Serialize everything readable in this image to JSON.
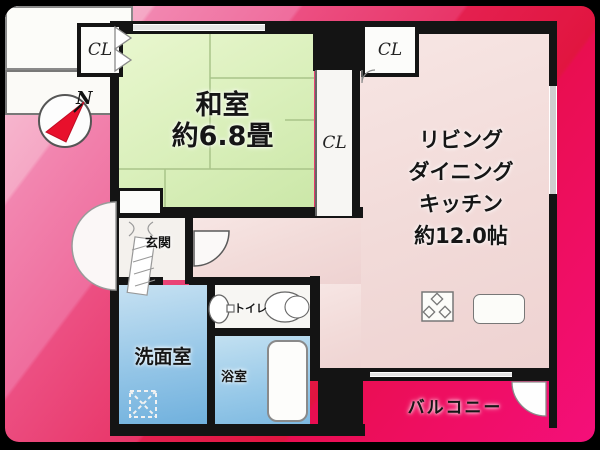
{
  "compass": {
    "label": "N"
  },
  "plan": {
    "closet_topleft": {
      "label": "CL"
    },
    "closet_topright": {
      "label": "CL"
    },
    "closet_tall": {
      "label": "CL"
    },
    "washitsu": {
      "name": "和室",
      "size": "約6.8畳"
    },
    "ldk": {
      "lines": [
        "リビング",
        "ダイニング",
        "キッチン",
        "約12.0帖"
      ]
    },
    "genkan": {
      "name": "玄関"
    },
    "toilet": {
      "name": "トイレ"
    },
    "washroom": {
      "name": "洗面室"
    },
    "bathroom": {
      "name": "浴室"
    },
    "balcony": {
      "name": "バルコニー"
    }
  },
  "colors": {
    "wall": "#141414",
    "washitsu_green": "#d9efba",
    "ldk_pink": "#f2dbd9",
    "water_blue": "#95c6e7",
    "background_pink": "#f286b0",
    "background_red": "#e90e50",
    "compass_needle_red": "#e8102c"
  }
}
